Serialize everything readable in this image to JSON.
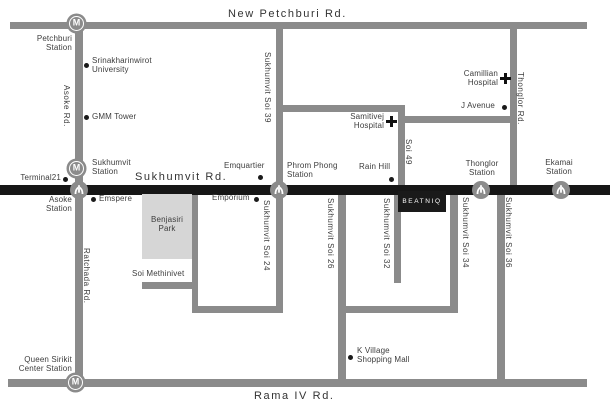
{
  "logo": {
    "brand": "BEATNIQ"
  },
  "icons": {
    "mrt_symbol": "M"
  },
  "roads": {
    "new_petchburi": "New Petchburi Rd.",
    "sukhumvit": "Sukhumvit Rd.",
    "rama_iv": "Rama IV Rd.",
    "asoke": "Asoke Rd.",
    "ratchada": "Ratchada Rd.",
    "thonglor": "Thonglor Rd.",
    "sukhumvit_soi_39": "Sukhumvit Soi 39",
    "soi_49": "Soi 49",
    "sukhumvit_soi_24": "Sukhumvit Soi 24",
    "sukhumvit_soi_26": "Sukhumvit Soi 26",
    "sukhumvit_soi_32": "Sukhumvit Soi 32",
    "sukhumvit_soi_34": "Sukhumvit Soi 34",
    "sukhumvit_soi_36": "Sukhumvit Soi 36",
    "soi_methinivet": "Soi Methinivet"
  },
  "stations": {
    "petchburi": "Petchburi\nStation",
    "sukhumvit": "Sukhumvit\nStation",
    "asoke": "Asoke\nStation",
    "phrom_phong": "Phrom Phong\nStation",
    "thonglor": "Thonglor\nStation",
    "ekamai": "Ekamai\nStation",
    "queen_sirikit": "Queen Sirikit\nCenter Station"
  },
  "places": {
    "srinakharinwirot": "Srinakharinwirot\nUniversity",
    "gmm_tower": "GMM Tower",
    "terminal21": "Terminal21",
    "emspere": "Emspere",
    "emquartier": "Emquartier",
    "emporium": "Emporium",
    "benjasiri_park": "Benjasiri\nPark",
    "rain_hill": "Rain Hill",
    "samitivej_hospital": "Samitivej\nHospital",
    "camillian_hospital": "Camillian\nHospital",
    "j_avenue": "J Avenue",
    "k_village": "K Village\nShopping Mall"
  },
  "colors": {
    "road_gray": "#8b8b8b",
    "road_black": "#161616",
    "park_fill": "#d6d6d6",
    "text": "#3d3d3d",
    "logo_bg": "#1a1a1a",
    "logo_text": "#ffffff"
  }
}
